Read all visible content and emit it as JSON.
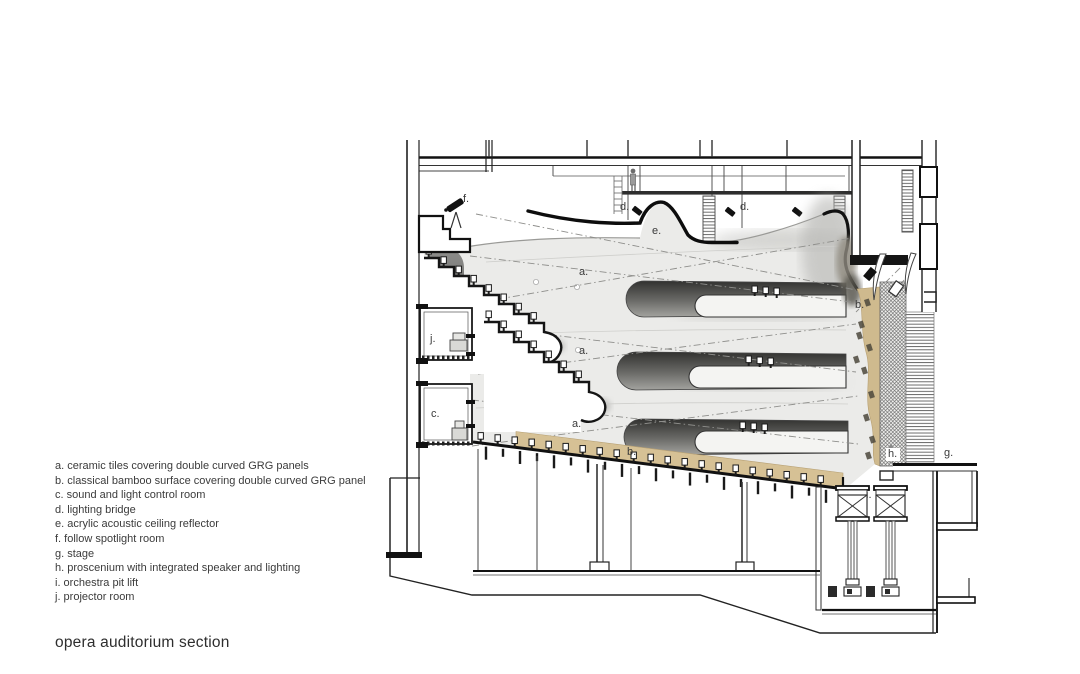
{
  "title": "opera auditorium section",
  "legend": {
    "items": [
      {
        "key": "a.",
        "label": "ceramic tiles covering double curved GRG panels"
      },
      {
        "key": "b.",
        "label": "classical bamboo surface covering double curved GRG panel"
      },
      {
        "key": "c.",
        "label": "sound and light control room"
      },
      {
        "key": "d.",
        "label": "lighting bridge"
      },
      {
        "key": "e.",
        "label": "acrylic acoustic ceiling reflector"
      },
      {
        "key": "f.",
        "label": "follow spotlight room"
      },
      {
        "key": "g.",
        "label": "stage"
      },
      {
        "key": "h.",
        "label": "proscenium with integrated speaker and lighting"
      },
      {
        "key": "i.",
        "label": "orchestra pit lift"
      },
      {
        "key": "j.",
        "label": "projector room"
      }
    ]
  },
  "drawing": {
    "labels": [
      {
        "text": "f.",
        "x": 463,
        "y": 193
      },
      {
        "text": "d.",
        "x": 620,
        "y": 201
      },
      {
        "text": "d.",
        "x": 740,
        "y": 201
      },
      {
        "text": "e.",
        "x": 652,
        "y": 225
      },
      {
        "text": "a.",
        "x": 579,
        "y": 266
      },
      {
        "text": "b.",
        "x": 855,
        "y": 299
      },
      {
        "text": "j.",
        "x": 430,
        "y": 333
      },
      {
        "text": "a.",
        "x": 579,
        "y": 345
      },
      {
        "text": "c.",
        "x": 431,
        "y": 408
      },
      {
        "text": "a.",
        "x": 572,
        "y": 418
      },
      {
        "text": "b.",
        "x": 627,
        "y": 446
      },
      {
        "text": "h.",
        "x": 886,
        "y": 448,
        "chip": true
      },
      {
        "text": "g.",
        "x": 944,
        "y": 447
      },
      {
        "text": "i.",
        "x": 866,
        "y": 489
      }
    ]
  },
  "colors": {
    "line": "#1a1a1a",
    "shell_light": "#ebebe9",
    "shell_shadow": "#9a9a97",
    "slot_dark": "#3a3a38",
    "bamboo": "#d6c195",
    "void_gray": "#868684"
  }
}
